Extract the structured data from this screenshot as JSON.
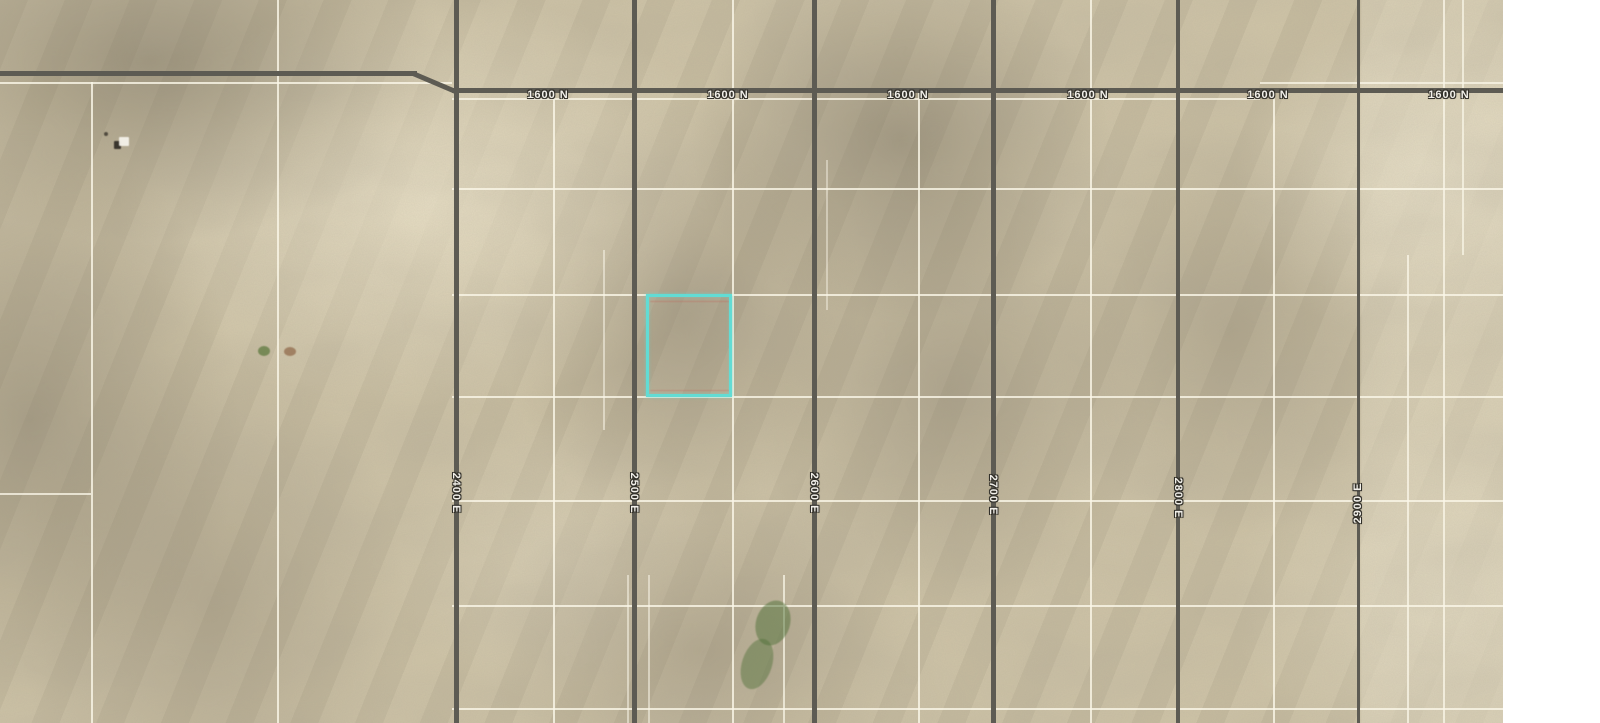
{
  "map": {
    "type": "satellite-parcel-map",
    "imagery": {
      "x": 0,
      "y": 0,
      "width": 1503,
      "height": 723,
      "base_color": "#cfc4a6",
      "margin_color": "#ffffff"
    },
    "highlight_parcel": {
      "x": 646,
      "y": 294,
      "width": 86,
      "height": 103,
      "color": "#62dcd4"
    },
    "roads": {
      "color": "#5d5b53",
      "label_color": "#f2f0ea",
      "horizontal_segments": [
        {
          "name": "1600 N main",
          "x": 452,
          "y": 88,
          "length": 1051,
          "thickness": 5,
          "rotate": 0
        },
        {
          "name": "1600 N west",
          "x": 0,
          "y": 71,
          "length": 417,
          "thickness": 5,
          "rotate": 0
        },
        {
          "name": "1600 N bend",
          "x": 413,
          "y": 71,
          "length": 48,
          "thickness": 5,
          "rotate": 23
        }
      ],
      "horizontal_labels": [
        {
          "text": "1600 N",
          "x": 548,
          "y": 95
        },
        {
          "text": "1600 N",
          "x": 728,
          "y": 95
        },
        {
          "text": "1600 N",
          "x": 908,
          "y": 95
        },
        {
          "text": "1600 N",
          "x": 1088,
          "y": 95
        },
        {
          "text": "1600 N",
          "x": 1268,
          "y": 95
        },
        {
          "text": "1600 N",
          "x": 1449,
          "y": 95
        }
      ],
      "vertical": [
        {
          "name": "2400 E",
          "x": 456,
          "width": 5,
          "label_y": 493,
          "label_rotation": 90
        },
        {
          "name": "2500 E",
          "x": 634,
          "width": 5,
          "label_y": 493,
          "label_rotation": 90
        },
        {
          "name": "2600 E",
          "x": 814,
          "width": 5,
          "label_y": 493,
          "label_rotation": 90
        },
        {
          "name": "2700 E",
          "x": 993,
          "width": 5,
          "label_y": 495,
          "label_rotation": 90
        },
        {
          "name": "2800 E",
          "x": 1178,
          "width": 4,
          "label_y": 498,
          "label_rotation": 90
        },
        {
          "name": "2900 E",
          "x": 1358,
          "width": 3,
          "label_y": 503,
          "label_rotation": -90
        }
      ]
    },
    "grid": {
      "white_color": "rgba(250,246,232,0.9)",
      "line_thickness": 2,
      "white_vlines": [
        {
          "x": 91,
          "y1": 82,
          "y2": 723,
          "opacity": 0.9
        },
        {
          "x": 277,
          "y1": 0,
          "y2": 723,
          "opacity": 0.9
        },
        {
          "x": 553,
          "y1": 88,
          "y2": 723,
          "opacity": 0.9
        },
        {
          "x": 732,
          "y1": 0,
          "y2": 723,
          "opacity": 0.9
        },
        {
          "x": 918,
          "y1": 88,
          "y2": 723,
          "opacity": 0.9
        },
        {
          "x": 1090,
          "y1": 0,
          "y2": 723,
          "opacity": 0.9
        },
        {
          "x": 1273,
          "y1": 88,
          "y2": 723,
          "opacity": 0.9
        },
        {
          "x": 1407,
          "y1": 255,
          "y2": 723,
          "opacity": 0.85
        },
        {
          "x": 1443,
          "y1": 0,
          "y2": 723,
          "opacity": 0.85
        },
        {
          "x": 1462,
          "y1": 0,
          "y2": 255,
          "opacity": 0.8
        },
        {
          "x": 603,
          "y1": 250,
          "y2": 430,
          "opacity": 0.6
        },
        {
          "x": 783,
          "y1": 575,
          "y2": 723,
          "opacity": 0.8
        },
        {
          "x": 627,
          "y1": 575,
          "y2": 723,
          "opacity": 0.6
        },
        {
          "x": 648,
          "y1": 575,
          "y2": 723,
          "opacity": 0.6
        },
        {
          "x": 826,
          "y1": 160,
          "y2": 310,
          "opacity": 0.5
        }
      ],
      "white_hlines": [
        {
          "y": 82,
          "x1": 0,
          "x2": 452,
          "opacity": 0.9
        },
        {
          "y": 82,
          "x1": 1260,
          "x2": 1503,
          "opacity": 0.85
        },
        {
          "y": 98,
          "x1": 452,
          "x2": 1260,
          "opacity": 0.85
        },
        {
          "y": 188,
          "x1": 452,
          "x2": 1503,
          "opacity": 0.9
        },
        {
          "y": 294,
          "x1": 452,
          "x2": 1503,
          "opacity": 0.9
        },
        {
          "y": 396,
          "x1": 452,
          "x2": 1503,
          "opacity": 0.9
        },
        {
          "y": 500,
          "x1": 452,
          "x2": 1503,
          "opacity": 0.9
        },
        {
          "y": 605,
          "x1": 452,
          "x2": 1503,
          "opacity": 0.9
        },
        {
          "y": 708,
          "x1": 452,
          "x2": 1503,
          "opacity": 0.9
        },
        {
          "y": 493,
          "x1": 0,
          "x2": 91,
          "opacity": 0.85
        }
      ]
    },
    "features": [
      {
        "name": "building-shadow",
        "x": 114,
        "y": 141,
        "w": 7,
        "h": 8,
        "color": "#2e2a24",
        "opacity": 0.9,
        "radius": "1px",
        "rotate": 0
      },
      {
        "name": "building-roof",
        "x": 119,
        "y": 137,
        "w": 10,
        "h": 9,
        "color": "#f5f2ea",
        "opacity": 0.95,
        "radius": "1px",
        "rotate": 0
      },
      {
        "name": "ground-dot",
        "x": 104,
        "y": 132,
        "w": 4,
        "h": 4,
        "color": "#3a352c",
        "opacity": 0.8,
        "radius": "50%",
        "rotate": 0
      },
      {
        "name": "vegetation-patch",
        "x": 258,
        "y": 346,
        "w": 12,
        "h": 10,
        "color": "#5f7a40",
        "opacity": 0.75,
        "radius": "50%",
        "rotate": 0
      },
      {
        "name": "soil-spot",
        "x": 284,
        "y": 347,
        "w": 12,
        "h": 9,
        "color": "#8a5f3f",
        "opacity": 0.65,
        "radius": "50%",
        "rotate": 0
      },
      {
        "name": "vegetation-streak",
        "x": 756,
        "y": 600,
        "w": 34,
        "h": 46,
        "color": "#4f7038",
        "opacity": 0.5,
        "radius": "50%",
        "rotate": 18
      },
      {
        "name": "vegetation-streak",
        "x": 742,
        "y": 638,
        "w": 30,
        "h": 52,
        "color": "#4f7038",
        "opacity": 0.45,
        "radius": "50%",
        "rotate": 18
      },
      {
        "name": "plat-line-red",
        "x": 650,
        "y": 301,
        "w": 80,
        "h": 1,
        "color": "#c06a5e",
        "opacity": 0.5,
        "radius": "0",
        "rotate": 0
      },
      {
        "name": "plat-line-red",
        "x": 650,
        "y": 390,
        "w": 80,
        "h": 1,
        "color": "#c06a5e",
        "opacity": 0.45,
        "radius": "0",
        "rotate": 0
      }
    ]
  }
}
